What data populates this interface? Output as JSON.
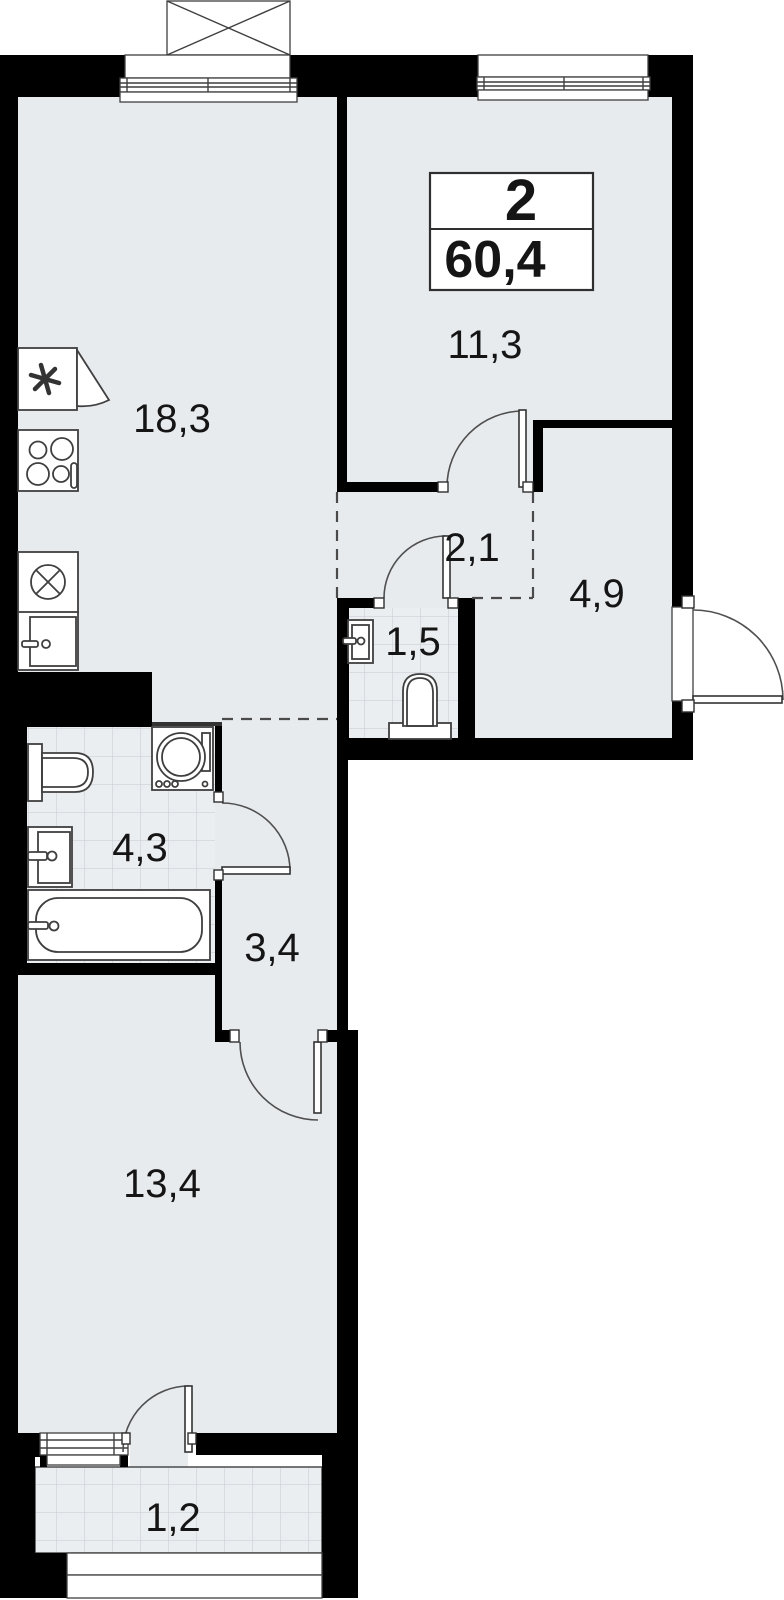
{
  "plan_summary": {
    "room_count": "2",
    "total_area": "60,4"
  },
  "rooms": [
    {
      "name": "kitchen-living-room",
      "area_label": "18,3"
    },
    {
      "name": "bedroom",
      "area_label": "11,3"
    },
    {
      "name": "hallway",
      "area_label": "2,1"
    },
    {
      "name": "entrance-hall",
      "area_label": "4,9"
    },
    {
      "name": "wc",
      "area_label": "1,5"
    },
    {
      "name": "bathroom",
      "area_label": "4,3"
    },
    {
      "name": "corridor",
      "area_label": "3,4"
    },
    {
      "name": "living-room",
      "area_label": "13,4"
    },
    {
      "name": "balcony",
      "area_label": "1,2"
    }
  ],
  "fixtures": [
    "fridge-icon",
    "cooktop-icon",
    "kitchen-sink-icon",
    "kitchen-cabinet-icon",
    "wc-sink-icon",
    "wc-toilet-icon",
    "bathroom-toilet-icon",
    "washing-machine-icon",
    "bathroom-sink-icon",
    "bathtub-icon"
  ],
  "doors": [
    "bedroom-door",
    "wc-door",
    "bathroom-door",
    "living-room-door",
    "balcony-door",
    "entry-door"
  ],
  "windows": [
    "kitchen-window",
    "bedroom-window",
    "living-room-window"
  ],
  "colors": {
    "wall": "#000000",
    "floor": "#e8ebee",
    "tile_floor": "#ebeef0",
    "tile_line": "#c6cbcf",
    "line": "#3f3f3f",
    "text": "#151515"
  }
}
